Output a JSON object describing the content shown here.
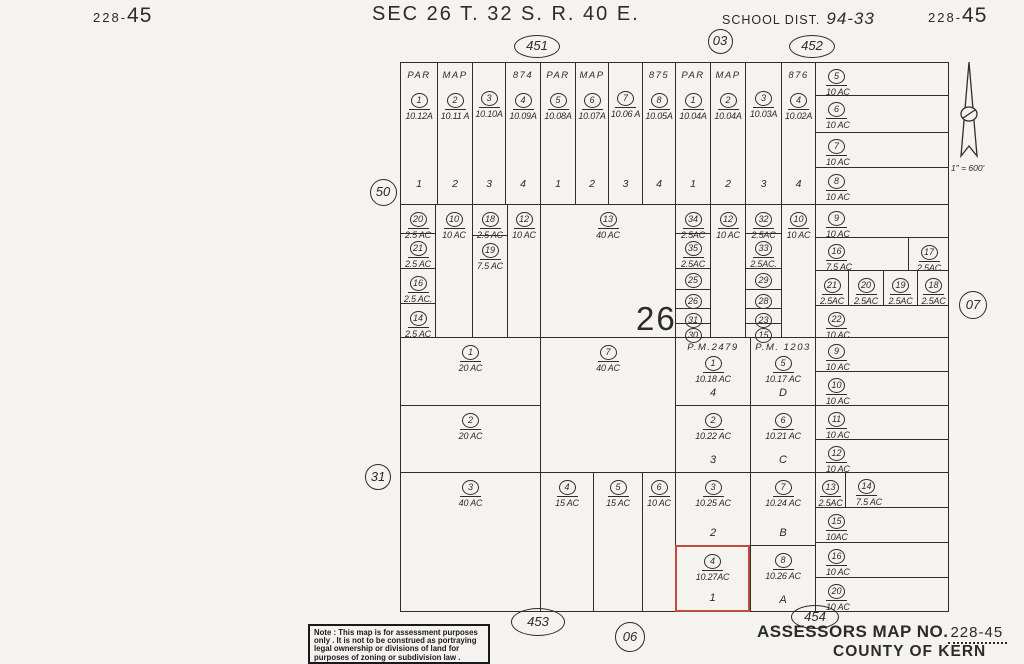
{
  "header": {
    "ref_left_small": "228-",
    "ref_left_big": "45",
    "section_title": "SEC 26 T. 32 S.   R. 40 E.",
    "school_label": "SCHOOL DIST.",
    "school_value": "94-33",
    "ref_right_small": "228-",
    "ref_right_big": "45"
  },
  "section_number": "26",
  "compass": {
    "scale": "1\" = 600'"
  },
  "footer": {
    "note_lines": [
      "Note : This map is for assessment purposes",
      "only . It is not to be construed as portraying",
      "legal ownership or divisions of land for",
      "purposes of zoning or subdivision law ."
    ],
    "assessor_label": "ASSESSORS MAP NO.",
    "assessor_value": "228-45",
    "county": "COUNTY OF KERN"
  },
  "colors": {
    "ink": "#2e2e2e",
    "paper": "#f4f3ef",
    "highlight_red": "#bf4a3e"
  },
  "markers": [
    {
      "label": "451",
      "shape": "e",
      "x": 537,
      "y": 46,
      "w": 46,
      "h": 23
    },
    {
      "label": "03",
      "shape": "c",
      "x": 720,
      "y": 41,
      "w": 25,
      "h": 25
    },
    {
      "label": "452",
      "shape": "e",
      "x": 812,
      "y": 46,
      "w": 46,
      "h": 23
    },
    {
      "label": "50",
      "shape": "c",
      "x": 383,
      "y": 192,
      "w": 27,
      "h": 27
    },
    {
      "label": "31",
      "shape": "c",
      "x": 378,
      "y": 477,
      "w": 26,
      "h": 26
    },
    {
      "label": "07",
      "shape": "c",
      "x": 973,
      "y": 305,
      "w": 28,
      "h": 28
    },
    {
      "label": "453",
      "shape": "e",
      "x": 538,
      "y": 622,
      "w": 54,
      "h": 28
    },
    {
      "label": "06",
      "shape": "c",
      "x": 630,
      "y": 637,
      "w": 30,
      "h": 30
    },
    {
      "label": "454",
      "shape": "e",
      "x": 815,
      "y": 617,
      "w": 48,
      "h": 24
    }
  ],
  "map": {
    "parcels": [
      {
        "x": 400,
        "y": 62,
        "w": 37,
        "h": 142,
        "b": 1,
        "hdr": "PAR",
        "n": "1",
        "ac": "10.12A",
        "num": "1"
      },
      {
        "x": 437,
        "y": 62,
        "w": 35,
        "h": 142,
        "b": 1,
        "hdr": "MAP",
        "n": "2",
        "ac": "10.11 A",
        "num": "2"
      },
      {
        "x": 472,
        "y": 62,
        "w": 33,
        "h": 142,
        "b": 1,
        "n": "3",
        "ac": "10.10A",
        "num": "3"
      },
      {
        "x": 505,
        "y": 62,
        "w": 35,
        "h": 142,
        "b": 1,
        "hdr": "874",
        "n": "4",
        "ac": "10.09A",
        "num": "4"
      },
      {
        "x": 540,
        "y": 62,
        "w": 35,
        "h": 142,
        "b": 1,
        "hdr": "PAR",
        "n": "5",
        "ac": "10.08A",
        "num": "1"
      },
      {
        "x": 575,
        "y": 62,
        "w": 33,
        "h": 142,
        "b": 1,
        "hdr": "MAP",
        "n": "6",
        "ac": "10.07A",
        "num": "2"
      },
      {
        "x": 608,
        "y": 62,
        "w": 34,
        "h": 142,
        "b": 1,
        "n": "7",
        "ac": "10.06 A",
        "num": "3"
      },
      {
        "x": 642,
        "y": 62,
        "w": 33,
        "h": 142,
        "b": 1,
        "hdr": "875",
        "n": "8",
        "ac": "10.05A",
        "num": "4"
      },
      {
        "x": 675,
        "y": 62,
        "w": 35,
        "h": 142,
        "b": 1,
        "hdr": "PAR",
        "n": "1",
        "ac": "10.04A",
        "num": "1"
      },
      {
        "x": 710,
        "y": 62,
        "w": 35,
        "h": 142,
        "b": 1,
        "hdr": "MAP",
        "n": "2",
        "ac": "10.04A",
        "num": "2"
      },
      {
        "x": 745,
        "y": 62,
        "w": 36,
        "h": 142,
        "b": 1,
        "n": "3",
        "ac": "10.03A",
        "num": "3"
      },
      {
        "x": 781,
        "y": 62,
        "w": 34,
        "h": 142,
        "b": 1,
        "hdr": "876",
        "n": "4",
        "ac": "10.02A",
        "num": "4"
      },
      {
        "x": 815,
        "y": 62,
        "w": 134,
        "h": 33,
        "n": "5",
        "ac": "10 AC",
        "a": "l"
      },
      {
        "x": 815,
        "y": 95,
        "w": 134,
        "h": 37,
        "n": "6",
        "ac": "10 AC",
        "a": "l"
      },
      {
        "x": 815,
        "y": 132,
        "w": 134,
        "h": 35,
        "n": "7",
        "ac": "10 AC",
        "a": "l"
      },
      {
        "x": 815,
        "y": 167,
        "w": 134,
        "h": 37,
        "n": "8",
        "ac": "10 AC",
        "a": "l"
      },
      {
        "x": 400,
        "y": 204,
        "w": 35,
        "h": 29,
        "n": "20",
        "ac": "2.5 AC"
      },
      {
        "x": 400,
        "y": 233,
        "w": 35,
        "h": 35,
        "n": "21",
        "ac": "2.5 AC"
      },
      {
        "x": 400,
        "y": 268,
        "w": 35,
        "h": 35,
        "n": "16",
        "ac": "2.5 AC."
      },
      {
        "x": 400,
        "y": 303,
        "w": 35,
        "h": 34,
        "n": "14",
        "ac": "2.5 AC"
      },
      {
        "x": 435,
        "y": 204,
        "w": 37,
        "h": 133,
        "n": "10",
        "ac": "10 AC"
      },
      {
        "x": 472,
        "y": 204,
        "w": 35,
        "h": 31,
        "n": "18",
        "ac": "2.5 AC"
      },
      {
        "x": 472,
        "y": 235,
        "w": 35,
        "h": 102,
        "n": "19",
        "ac": "7.5 AC"
      },
      {
        "x": 507,
        "y": 204,
        "w": 33,
        "h": 133,
        "n": "12",
        "ac": "10 AC"
      },
      {
        "x": 540,
        "y": 204,
        "w": 135,
        "h": 133,
        "n": "13",
        "ac": "40 AC"
      },
      {
        "x": 675,
        "y": 204,
        "w": 35,
        "h": 29,
        "n": "34",
        "ac": "2.5AC"
      },
      {
        "x": 675,
        "y": 233,
        "w": 35,
        "h": 35,
        "n": "35",
        "ac": "2.5AC"
      },
      {
        "x": 675,
        "y": 268,
        "w": 35,
        "h": 21,
        "n": "25",
        "t": 1
      },
      {
        "x": 675,
        "y": 289,
        "w": 35,
        "h": 19,
        "n": "26",
        "t": 1
      },
      {
        "x": 675,
        "y": 308,
        "w": 35,
        "h": 15,
        "n": "31",
        "t": 1
      },
      {
        "x": 675,
        "y": 323,
        "w": 35,
        "h": 14,
        "n": "30",
        "t": 1
      },
      {
        "x": 710,
        "y": 204,
        "w": 35,
        "h": 133,
        "n": "12",
        "ac": "10 AC"
      },
      {
        "x": 745,
        "y": 204,
        "w": 36,
        "h": 29,
        "n": "32",
        "ac": "2.5AC"
      },
      {
        "x": 745,
        "y": 233,
        "w": 36,
        "h": 35,
        "n": "33",
        "ac": "2.5AC."
      },
      {
        "x": 745,
        "y": 268,
        "w": 36,
        "h": 21,
        "n": "29",
        "t": 1
      },
      {
        "x": 745,
        "y": 289,
        "w": 36,
        "h": 19,
        "n": "28",
        "t": 1
      },
      {
        "x": 745,
        "y": 308,
        "w": 36,
        "h": 15,
        "n": "23",
        "t": 1
      },
      {
        "x": 745,
        "y": 323,
        "w": 36,
        "h": 14,
        "n": "15",
        "t": 1
      },
      {
        "x": 781,
        "y": 204,
        "w": 34,
        "h": 133,
        "n": "10",
        "ac": "10 AC"
      },
      {
        "x": 815,
        "y": 204,
        "w": 134,
        "h": 33,
        "n": "9",
        "ac": "10 AC",
        "a": "l"
      },
      {
        "x": 815,
        "y": 237,
        "w": 93,
        "h": 33,
        "n": "16",
        "ac": "7.5 AC",
        "a": "l"
      },
      {
        "x": 908,
        "y": 237,
        "w": 41,
        "h": 33,
        "n": "17",
        "ac": "2.5AC"
      },
      {
        "x": 815,
        "y": 270,
        "w": 33,
        "h": 35,
        "n": "21",
        "ac": "2.5AC"
      },
      {
        "x": 848,
        "y": 270,
        "w": 35,
        "h": 35,
        "n": "20",
        "ac": "2.5AC"
      },
      {
        "x": 883,
        "y": 270,
        "w": 34,
        "h": 35,
        "n": "19",
        "ac": "2.5AC"
      },
      {
        "x": 917,
        "y": 270,
        "w": 32,
        "h": 35,
        "n": "18",
        "ac": "2.5AC"
      },
      {
        "x": 815,
        "y": 305,
        "w": 134,
        "h": 32,
        "n": "22",
        "ac": "10 AC",
        "a": "l"
      },
      {
        "x": 400,
        "y": 337,
        "w": 140,
        "h": 68,
        "n": "1",
        "ac": "20 AC"
      },
      {
        "x": 400,
        "y": 405,
        "w": 140,
        "h": 67,
        "n": "2",
        "ac": "20 AC"
      },
      {
        "x": 540,
        "y": 337,
        "w": 135,
        "h": 135,
        "n": "7",
        "ac": "40 AC"
      },
      {
        "x": 675,
        "y": 337,
        "w": 75,
        "h": 68,
        "hdr": "P.M.2479",
        "n": "1",
        "ac": "10.18 AC",
        "lot": "4"
      },
      {
        "x": 675,
        "y": 405,
        "w": 75,
        "h": 67,
        "n": "2",
        "ac": "10.22 AC",
        "lot": "3"
      },
      {
        "x": 750,
        "y": 337,
        "w": 65,
        "h": 68,
        "hdr": "P.M. 1203",
        "n": "5",
        "ac": "10.17 AC",
        "lot": "D"
      },
      {
        "x": 750,
        "y": 405,
        "w": 65,
        "h": 67,
        "n": "6",
        "ac": "10.21 AC",
        "lot": "C"
      },
      {
        "x": 815,
        "y": 337,
        "w": 134,
        "h": 34,
        "n": "9",
        "ac": "10 AC",
        "a": "l"
      },
      {
        "x": 815,
        "y": 371,
        "w": 134,
        "h": 34,
        "n": "10",
        "ac": "10 AC",
        "a": "l"
      },
      {
        "x": 815,
        "y": 405,
        "w": 134,
        "h": 34,
        "n": "11",
        "ac": "10 AC",
        "a": "l"
      },
      {
        "x": 815,
        "y": 439,
        "w": 134,
        "h": 33,
        "n": "12",
        "ac": "10 AC",
        "a": "l"
      },
      {
        "x": 400,
        "y": 472,
        "w": 140,
        "h": 140,
        "n": "3",
        "ac": "40 AC"
      },
      {
        "x": 540,
        "y": 472,
        "w": 53,
        "h": 140,
        "n": "4",
        "ac": "15 AC"
      },
      {
        "x": 593,
        "y": 472,
        "w": 49,
        "h": 140,
        "n": "5",
        "ac": "15 AC"
      },
      {
        "x": 642,
        "y": 472,
        "w": 33,
        "h": 140,
        "n": "6",
        "ac": "10 AC"
      },
      {
        "x": 675,
        "y": 472,
        "w": 75,
        "h": 73,
        "n": "3",
        "ac": "10.25 AC",
        "lot": "2"
      },
      {
        "x": 675,
        "y": 545,
        "w": 75,
        "h": 67,
        "n": "4",
        "ac": "10.27AC",
        "lot": "1",
        "red": 1
      },
      {
        "x": 750,
        "y": 472,
        "w": 65,
        "h": 73,
        "n": "7",
        "ac": "10.24 AC",
        "lot": "B"
      },
      {
        "x": 750,
        "y": 545,
        "w": 65,
        "h": 67,
        "n": "8",
        "ac": "10.26 AC",
        "lot": "A"
      },
      {
        "x": 815,
        "y": 472,
        "w": 30,
        "h": 35,
        "n": "13",
        "ac": "2.5AC"
      },
      {
        "x": 845,
        "y": 472,
        "w": 104,
        "h": 35,
        "n": "14",
        "ac": "7.5 AC",
        "a": "l"
      },
      {
        "x": 815,
        "y": 507,
        "w": 134,
        "h": 35,
        "n": "15",
        "ac": "10AC",
        "a": "l"
      },
      {
        "x": 815,
        "y": 542,
        "w": 134,
        "h": 35,
        "n": "16",
        "ac": "10 AC",
        "a": "l"
      },
      {
        "x": 815,
        "y": 577,
        "w": 134,
        "h": 35,
        "n": "20",
        "ac": "10 AC",
        "a": "l"
      }
    ]
  }
}
